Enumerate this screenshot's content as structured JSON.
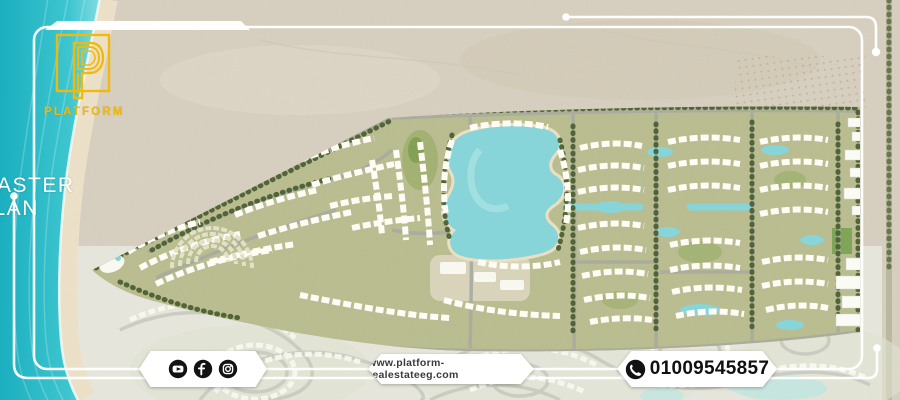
{
  "brand": {
    "logo_word": "PLATFORM",
    "logo_letter": "P"
  },
  "overlay": {
    "master_plan_line1": "MASTER",
    "master_plan_line2": "PLAN"
  },
  "footer": {
    "social_icons": [
      "youtube-icon",
      "facebook-icon",
      "instagram-icon"
    ],
    "website": "www.platform-realestateeg.com",
    "phone": "01009545857"
  },
  "map": {
    "description_elements": [
      "sea",
      "beach",
      "desert-sand",
      "masterplan-villages",
      "lagoons",
      "faded-existing-phase"
    ]
  },
  "colors": {
    "accent_yellow": "#F2B90D",
    "sea": "#2BBCCA",
    "lagoon": "#87D5DA",
    "frame_white": "#FFFFFF",
    "sand": "#D9D1C1",
    "vivid_base": "#B9BD90",
    "washed_base": "#E6E6DC",
    "icon_black": "#121212",
    "footer_text": "#3A3A3A"
  }
}
